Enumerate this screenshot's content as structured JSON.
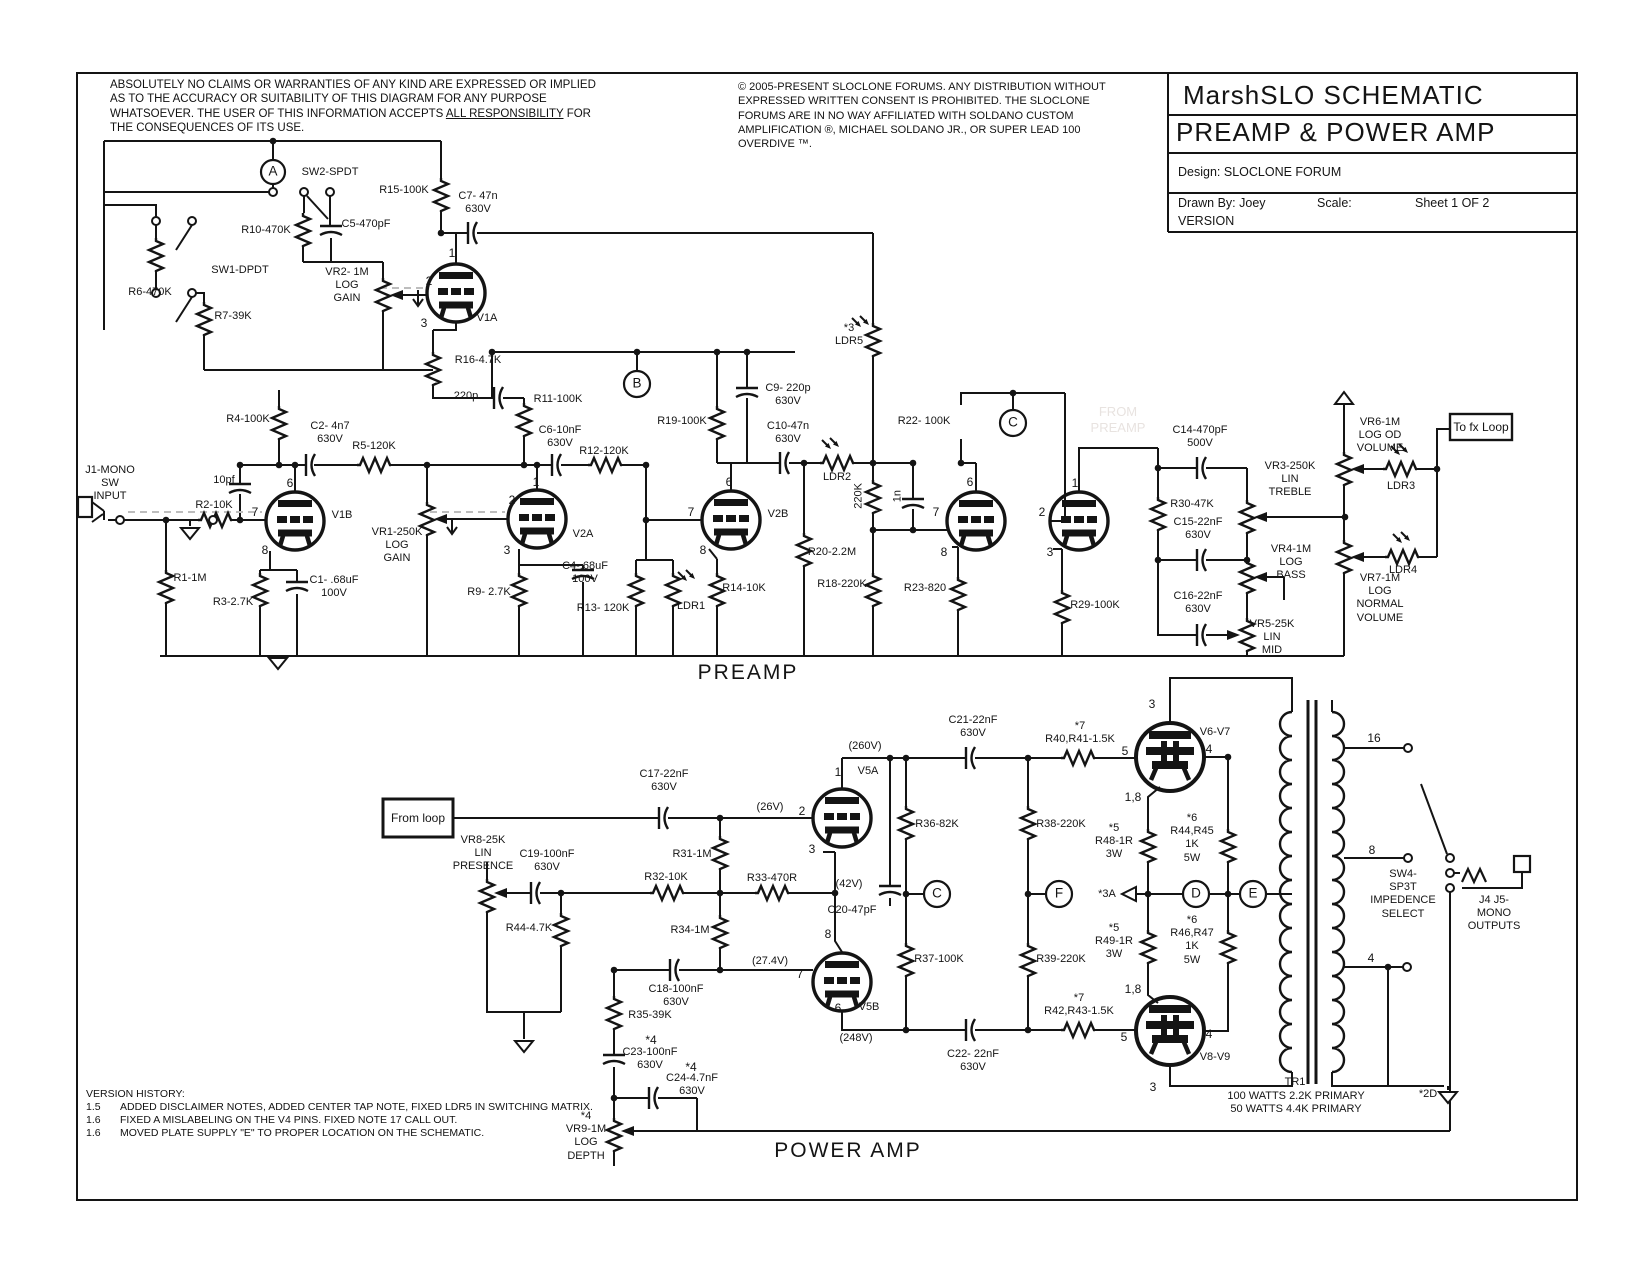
{
  "header": {
    "disclaimer_pre": "ABSOLUTELY NO CLAIMS OR WARRANTIES OF ANY KIND ARE EXPRESSED OR IMPLIED AS TO THE ACCURACY OR SUITABILITY OF THIS DIAGRAM FOR ANY PURPOSE WHATSOEVER. THE USER OF THIS INFORMATION ACCEPTS ",
    "disclaimer_underlined": "ALL RESPONSIBILITY",
    "disclaimer_post": " FOR THE CONSEQUENCES OF ITS USE.",
    "copyright": "© 2005-PRESENT SLOCLONE FORUMS. ANY DISTRIBUTION WITHOUT EXPRESSED WRITTEN CONSENT IS PROHIBITED. THE SLOCLONE FORUMS ARE IN NO WAY AFFILIATED WITH SOLDANO CUSTOM AMPLIFICATION ®, MICHAEL SOLDANO JR., OR SUPER LEAD 100 OVERDIVE ™."
  },
  "title_block": {
    "title_line1": "MarshSLO  SCHEMATIC",
    "title_line2": "PREAMP & POWER AMP",
    "design": "Design: SLOCLONE FORUM",
    "drawn_by": "Drawn By: Joey",
    "scale": "Scale:",
    "sheet": "Sheet 1 OF 2",
    "version": "VERSION"
  },
  "version_history": {
    "heading": "VERSION HISTORY:",
    "entries": [
      {
        "num": "1.5",
        "text": "ADDED DISCLAIMER NOTES, ADDED CENTER TAP NOTE, FIXED LDR5 IN SWITCHING MATRIX."
      },
      {
        "num": "1.6",
        "text": "FIXED A MISLABELING ON THE V4 PINS. FIXED NOTE 17 CALL OUT."
      },
      {
        "num": "1.6",
        "text": "MOVED PLATE SUPPLY \"E\" TO PROPER LOCATION ON THE SCHEMATIC."
      }
    ]
  },
  "labels": [
    {
      "t": "A",
      "x": 273,
      "y": 172,
      "c": "node",
      "n": "node-a"
    },
    {
      "t": "SW2-SPDT",
      "x": 330,
      "y": 166,
      "n": "sw2-label"
    },
    {
      "t": "R15-100K",
      "x": 404,
      "y": 184
    },
    {
      "t": "C7- 47n\n630V",
      "x": 478,
      "y": 190
    },
    {
      "t": "R10-470K",
      "x": 266,
      "y": 224
    },
    {
      "t": "C5-470pF",
      "x": 366,
      "y": 218
    },
    {
      "t": "SW1-DPDT",
      "x": 240,
      "y": 264,
      "n": "sw1-label"
    },
    {
      "t": "R6-470K",
      "x": 150,
      "y": 286
    },
    {
      "t": "R7-39K",
      "x": 233,
      "y": 310
    },
    {
      "t": "VR2- 1M\nLOG\nGAIN",
      "x": 347,
      "y": 266
    },
    {
      "t": "1",
      "x": 452,
      "y": 246,
      "c": "pin"
    },
    {
      "t": "2",
      "x": 429,
      "y": 274,
      "c": "pin"
    },
    {
      "t": "3",
      "x": 424,
      "y": 316,
      "c": "pin"
    },
    {
      "t": "V1A",
      "x": 487,
      "y": 312
    },
    {
      "t": "R16-4.7K",
      "x": 478,
      "y": 354
    },
    {
      "t": "*3\nLDR5",
      "x": 849,
      "y": 322
    },
    {
      "t": "220p",
      "x": 466,
      "y": 390
    },
    {
      "t": "R11-100K",
      "x": 558,
      "y": 393
    },
    {
      "t": "B",
      "x": 637,
      "y": 384,
      "c": "node",
      "n": "node-b"
    },
    {
      "t": "C9- 220p\n630V",
      "x": 788,
      "y": 382
    },
    {
      "t": "R19-100K",
      "x": 682,
      "y": 415
    },
    {
      "t": "C10-47n\n630V",
      "x": 788,
      "y": 420
    },
    {
      "t": "R4-100K",
      "x": 248,
      "y": 413
    },
    {
      "t": "C2- 4n7\n630V",
      "x": 330,
      "y": 420
    },
    {
      "t": "R5-120K",
      "x": 374,
      "y": 440
    },
    {
      "t": "C6-10nF\n630V",
      "x": 560,
      "y": 424
    },
    {
      "t": "R12-120K",
      "x": 604,
      "y": 445
    },
    {
      "t": "R22- 100K",
      "x": 924,
      "y": 415
    },
    {
      "t": "C",
      "x": 1013,
      "y": 423,
      "c": "node",
      "n": "node-c-preamp"
    },
    {
      "t": "C14-470pF\n500V",
      "x": 1200,
      "y": 424
    },
    {
      "t": "VR6-1M\nLOG OD\nVOLUME",
      "x": 1380,
      "y": 416
    },
    {
      "t": "To fx Loop",
      "x": 1481,
      "y": 427,
      "c": "boxtext",
      "n": "to-fx-loop-box-label"
    },
    {
      "t": "VR3-250K\nLIN\nTREBLE",
      "x": 1290,
      "y": 460
    },
    {
      "t": "R30-47K",
      "x": 1192,
      "y": 498
    },
    {
      "t": "C15-22nF\n630V",
      "x": 1198,
      "y": 516
    },
    {
      "t": "J1-MONO\nSW\nINPUT",
      "x": 110,
      "y": 464,
      "n": "input-jack-label"
    },
    {
      "t": "10pf",
      "x": 224,
      "y": 474
    },
    {
      "t": "R2-10K",
      "x": 214,
      "y": 499
    },
    {
      "t": "6",
      "x": 290,
      "y": 476,
      "c": "pin"
    },
    {
      "t": "7",
      "x": 255,
      "y": 505,
      "c": "pin"
    },
    {
      "t": "8",
      "x": 265,
      "y": 543,
      "c": "pin"
    },
    {
      "t": "V1B",
      "x": 342,
      "y": 509
    },
    {
      "t": "LDR2",
      "x": 837,
      "y": 471
    },
    {
      "t": "220K",
      "x": 859,
      "y": 483,
      "c": "vert"
    },
    {
      "t": "1n",
      "x": 898,
      "y": 490,
      "c": "vert"
    },
    {
      "t": "V2A",
      "x": 583,
      "y": 528
    },
    {
      "t": "1",
      "x": 536,
      "y": 475,
      "c": "pin"
    },
    {
      "t": "2",
      "x": 512,
      "y": 493,
      "c": "pin"
    },
    {
      "t": "3",
      "x": 507,
      "y": 543,
      "c": "pin"
    },
    {
      "t": "V2B",
      "x": 778,
      "y": 508
    },
    {
      "t": "6",
      "x": 729,
      "y": 475,
      "c": "pin"
    },
    {
      "t": "7",
      "x": 691,
      "y": 505,
      "c": "pin"
    },
    {
      "t": "8",
      "x": 703,
      "y": 543,
      "c": "pin"
    },
    {
      "t": "R20-2.2M",
      "x": 832,
      "y": 546
    },
    {
      "t": "VR1-250K\nLOG\nGAIN",
      "x": 397,
      "y": 526
    },
    {
      "t": "LDR3",
      "x": 1401,
      "y": 480
    },
    {
      "t": "LDR4",
      "x": 1403,
      "y": 564
    },
    {
      "t": "VR4-1M\nLOG\nBASS",
      "x": 1291,
      "y": 543
    },
    {
      "t": "R18-220K",
      "x": 842,
      "y": 578
    },
    {
      "t": "R23-820",
      "x": 925,
      "y": 582
    },
    {
      "t": "C16-22nF\n630V",
      "x": 1198,
      "y": 590
    },
    {
      "t": "R29-100K",
      "x": 1095,
      "y": 599
    },
    {
      "t": "VR7-1M\nLOG\nNORMAL\nVOLUME",
      "x": 1380,
      "y": 572
    },
    {
      "t": "VR5-25K\nLIN\nMID",
      "x": 1272,
      "y": 618
    },
    {
      "t": "R1-1M",
      "x": 190,
      "y": 572
    },
    {
      "t": "R3-2.7K",
      "x": 233,
      "y": 596
    },
    {
      "t": "C1- .68uF\n100V",
      "x": 334,
      "y": 574
    },
    {
      "t": "R9- 2.7K",
      "x": 489,
      "y": 586
    },
    {
      "t": "C4-.68uF\n100V",
      "x": 585,
      "y": 560
    },
    {
      "t": "R13- 120K",
      "x": 603,
      "y": 602
    },
    {
      "t": "LDR1",
      "x": 691,
      "y": 600
    },
    {
      "t": "R14-10K",
      "x": 744,
      "y": 582
    },
    {
      "t": "6",
      "x": 970,
      "y": 475,
      "c": "pin"
    },
    {
      "t": "7",
      "x": 936,
      "y": 505,
      "c": "pin"
    },
    {
      "t": "8",
      "x": 944,
      "y": 545,
      "c": "pin"
    },
    {
      "t": "1",
      "x": 1075,
      "y": 476,
      "c": "pin"
    },
    {
      "t": "2",
      "x": 1042,
      "y": 505,
      "c": "pin"
    },
    {
      "t": "3",
      "x": 1050,
      "y": 545,
      "c": "pin"
    },
    {
      "t": "FROM\nPREAMP",
      "x": 1118,
      "y": 404,
      "c": "watermark",
      "n": "watermark"
    },
    {
      "t": "PREAMP",
      "x": 748,
      "y": 660,
      "c": "big",
      "n": "preamp-section-title"
    },
    {
      "t": "C21-22nF\n630V",
      "x": 973,
      "y": 714
    },
    {
      "t": "*7\nR40,R41-1.5K",
      "x": 1080,
      "y": 720
    },
    {
      "t": "3",
      "x": 1152,
      "y": 697,
      "c": "pin"
    },
    {
      "t": "V6-V7",
      "x": 1215,
      "y": 726
    },
    {
      "t": "5",
      "x": 1125,
      "y": 744,
      "c": "pin"
    },
    {
      "t": "4",
      "x": 1209,
      "y": 742,
      "c": "pin"
    },
    {
      "t": "1,8",
      "x": 1133,
      "y": 790,
      "c": "pin"
    },
    {
      "t": "(260V)",
      "x": 865,
      "y": 740
    },
    {
      "t": "1",
      "x": 838,
      "y": 765,
      "c": "pin"
    },
    {
      "t": "V5A",
      "x": 868,
      "y": 765
    },
    {
      "t": "2",
      "x": 802,
      "y": 804,
      "c": "pin"
    },
    {
      "t": "3",
      "x": 812,
      "y": 842,
      "c": "pin"
    },
    {
      "t": "C17-22nF\n630V",
      "x": 664,
      "y": 768
    },
    {
      "t": "From loop",
      "x": 418,
      "y": 818,
      "c": "boxtext",
      "n": "from-loop-box-label"
    },
    {
      "t": "(26V)",
      "x": 770,
      "y": 801
    },
    {
      "t": "VR8-25K\nLIN\nPRESENCE",
      "x": 483,
      "y": 834
    },
    {
      "t": "C19-100nF\n630V",
      "x": 547,
      "y": 848
    },
    {
      "t": "R31-1M",
      "x": 692,
      "y": 848
    },
    {
      "t": "R32-10K",
      "x": 666,
      "y": 871
    },
    {
      "t": "R33-470R",
      "x": 772,
      "y": 872
    },
    {
      "t": "R36-82K",
      "x": 937,
      "y": 818
    },
    {
      "t": "R38-220K",
      "x": 1061,
      "y": 818
    },
    {
      "t": "*5\nR48-1R\n3W",
      "x": 1114,
      "y": 822
    },
    {
      "t": "*6\nR44,R45\n1K\n5W",
      "x": 1192,
      "y": 812
    },
    {
      "t": "(42V)",
      "x": 849,
      "y": 878
    },
    {
      "t": "C20-47pF",
      "x": 852,
      "y": 904
    },
    {
      "t": "C",
      "x": 937,
      "y": 894,
      "c": "node",
      "n": "node-c-poweramp"
    },
    {
      "t": "F",
      "x": 1059,
      "y": 894,
      "c": "node",
      "n": "node-f"
    },
    {
      "t": "*3A",
      "x": 1107,
      "y": 888
    },
    {
      "t": "D",
      "x": 1196,
      "y": 894,
      "c": "node",
      "n": "node-d"
    },
    {
      "t": "E",
      "x": 1253,
      "y": 894,
      "c": "node",
      "n": "node-e"
    },
    {
      "t": "SW4-\nSP3T\nIMPEDENCE\nSELECT",
      "x": 1403,
      "y": 868,
      "n": "sw4-label"
    },
    {
      "t": "J4 J5-\nMONO\nOUTPUTS",
      "x": 1494,
      "y": 894,
      "n": "output-jacks-label"
    },
    {
      "t": "R44-4.7K",
      "x": 529,
      "y": 922
    },
    {
      "t": "R34-1M",
      "x": 690,
      "y": 924
    },
    {
      "t": "8",
      "x": 828,
      "y": 927,
      "c": "pin"
    },
    {
      "t": "(27.4V)",
      "x": 770,
      "y": 955
    },
    {
      "t": "7",
      "x": 800,
      "y": 967,
      "c": "pin"
    },
    {
      "t": "R37-100K",
      "x": 939,
      "y": 953
    },
    {
      "t": "R39-220K",
      "x": 1061,
      "y": 953
    },
    {
      "t": "*5\nR49-1R\n3W",
      "x": 1114,
      "y": 922
    },
    {
      "t": "*6\nR46,R47\n1K\n5W",
      "x": 1192,
      "y": 914
    },
    {
      "t": "C18-100nF\n630V",
      "x": 676,
      "y": 983
    },
    {
      "t": "R35-39K",
      "x": 650,
      "y": 1009
    },
    {
      "t": "6",
      "x": 838,
      "y": 1001,
      "c": "pin"
    },
    {
      "t": "V5B",
      "x": 869,
      "y": 1001
    },
    {
      "t": "(248V)",
      "x": 856,
      "y": 1032
    },
    {
      "t": "1,8",
      "x": 1133,
      "y": 982,
      "c": "pin"
    },
    {
      "t": "*7\nR42,R43-1.5K",
      "x": 1079,
      "y": 992
    },
    {
      "t": "5",
      "x": 1124,
      "y": 1030,
      "c": "pin"
    },
    {
      "t": "4",
      "x": 1209,
      "y": 1027,
      "c": "pin"
    },
    {
      "t": "V8-V9",
      "x": 1215,
      "y": 1051
    },
    {
      "t": "3",
      "x": 1153,
      "y": 1080,
      "c": "pin"
    },
    {
      "t": "C22- 22nF\n630V",
      "x": 973,
      "y": 1048
    },
    {
      "t": "*4",
      "x": 651,
      "y": 1033,
      "c": "pin"
    },
    {
      "t": "C23-100nF\n630V",
      "x": 650,
      "y": 1046
    },
    {
      "t": "*4",
      "x": 691,
      "y": 1060,
      "c": "pin"
    },
    {
      "t": "C24-4.7nF\n630V",
      "x": 692,
      "y": 1072
    },
    {
      "t": "*4\nVR9-1M\nLOG\nDEPTH",
      "x": 586,
      "y": 1110
    },
    {
      "t": "POWER AMP",
      "x": 848,
      "y": 1138,
      "c": "big",
      "n": "poweramp-section-title"
    },
    {
      "t": "16",
      "x": 1374,
      "y": 731,
      "c": "pin"
    },
    {
      "t": "8",
      "x": 1372,
      "y": 843,
      "c": "pin"
    },
    {
      "t": "4",
      "x": 1371,
      "y": 951,
      "c": "pin"
    },
    {
      "t": "TR1",
      "x": 1295,
      "y": 1076,
      "n": "transformer-label"
    },
    {
      "t": "100 WATTS 2.2K PRIMARY\n50 WATTS 4.4K PRIMARY",
      "x": 1296,
      "y": 1090,
      "c": "trnote",
      "n": "transformer-note"
    },
    {
      "t": "*2D",
      "x": 1428,
      "y": 1088
    }
  ]
}
